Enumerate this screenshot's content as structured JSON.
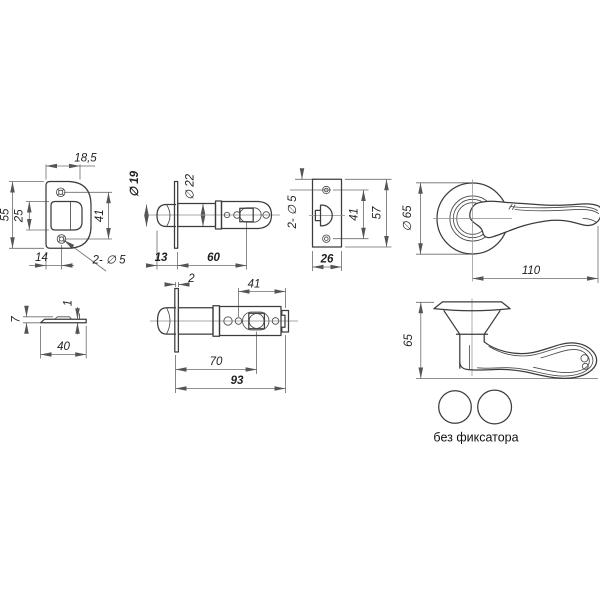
{
  "colors": {
    "background": "#ffffff",
    "part_line": "#3c3c3c",
    "dim_line": "#6b6b6b",
    "text": "#1f1f1f"
  },
  "views": {
    "faceplate_front": {
      "dims": {
        "top_width": "18,5",
        "height": "55",
        "opening_height": "25",
        "hole_spacing": "41",
        "bottom_width": "14",
        "holes_note": "2- ∅ 5"
      }
    },
    "latch_top": {
      "dims": {
        "bolt_diameter": "∅ 19",
        "barrel_diameter": "∅ 22",
        "bolt_length": "13",
        "barrel_length": "60"
      }
    },
    "strike_plate": {
      "dims": {
        "holes_note": "2- ∅ 5",
        "hole_spacing": "41",
        "height": "57",
        "width": "26"
      }
    },
    "handle_front": {
      "dims": {
        "rose_diameter": "∅ 65",
        "lever_length": "110"
      }
    },
    "faceplate_edge": {
      "dims": {
        "height": "7",
        "thickness": "1",
        "width": "40"
      }
    },
    "latch_bottom": {
      "dims": {
        "faceplate_thickness": "2",
        "end_section": "41",
        "backset": "70",
        "total_length": "93"
      }
    },
    "handle_side": {
      "dims": {
        "height": "65"
      }
    },
    "variant": {
      "caption": "без фиксатора"
    }
  }
}
